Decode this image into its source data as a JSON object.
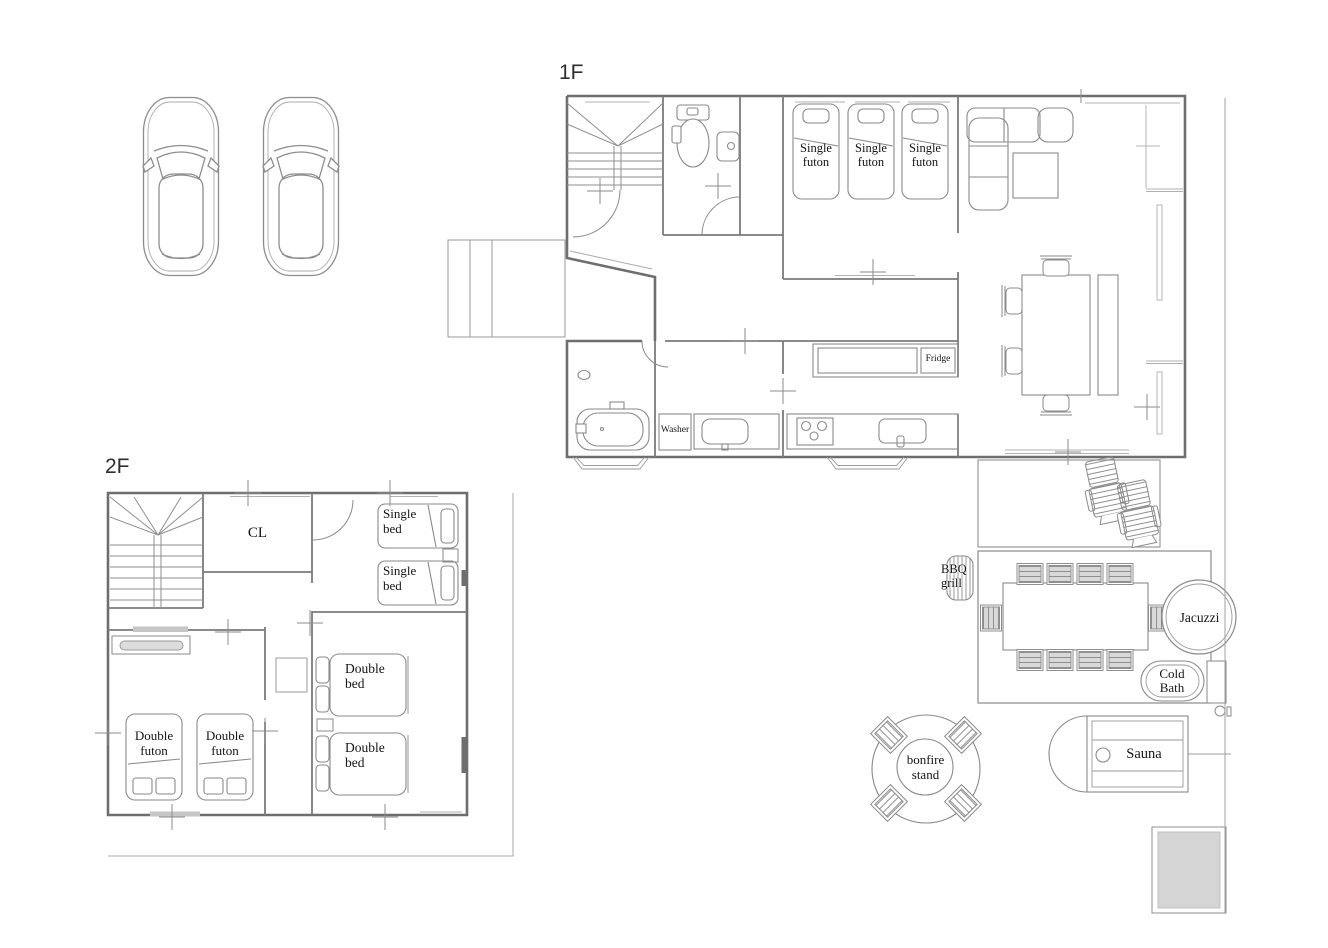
{
  "colors": {
    "wall_line": "#6e6e6e",
    "interior_line": "#7b7b7b",
    "furniture_line": "#8a8a8a",
    "chair_fill": "#d9d9d9",
    "slab_fill": "#d5d5d5",
    "text": "#141414"
  },
  "floors": {
    "f1": {
      "title": "1F",
      "futons": [
        {
          "label": "Single futon"
        },
        {
          "label": "Single futon"
        },
        {
          "label": "Single futon"
        }
      ],
      "fridge_label": "Fridge",
      "washer_label": "Washer"
    },
    "f2": {
      "title": "2F",
      "closet_label": "CL",
      "single_beds": [
        {
          "label": "Single bed"
        },
        {
          "label": "Single bed"
        }
      ],
      "double_futons": [
        {
          "label": "Double futon"
        },
        {
          "label": "Double futon"
        }
      ],
      "double_beds": [
        {
          "label": "Double bed"
        },
        {
          "label": "Double bed"
        }
      ]
    }
  },
  "outdoor": {
    "bbq_label": "BBQ grill",
    "jacuzzi_label": "Jacuzzi",
    "cold_bath_label": "Cold Bath",
    "sauna_label": "Sauna",
    "bonfire_label": "bonfire stand"
  }
}
